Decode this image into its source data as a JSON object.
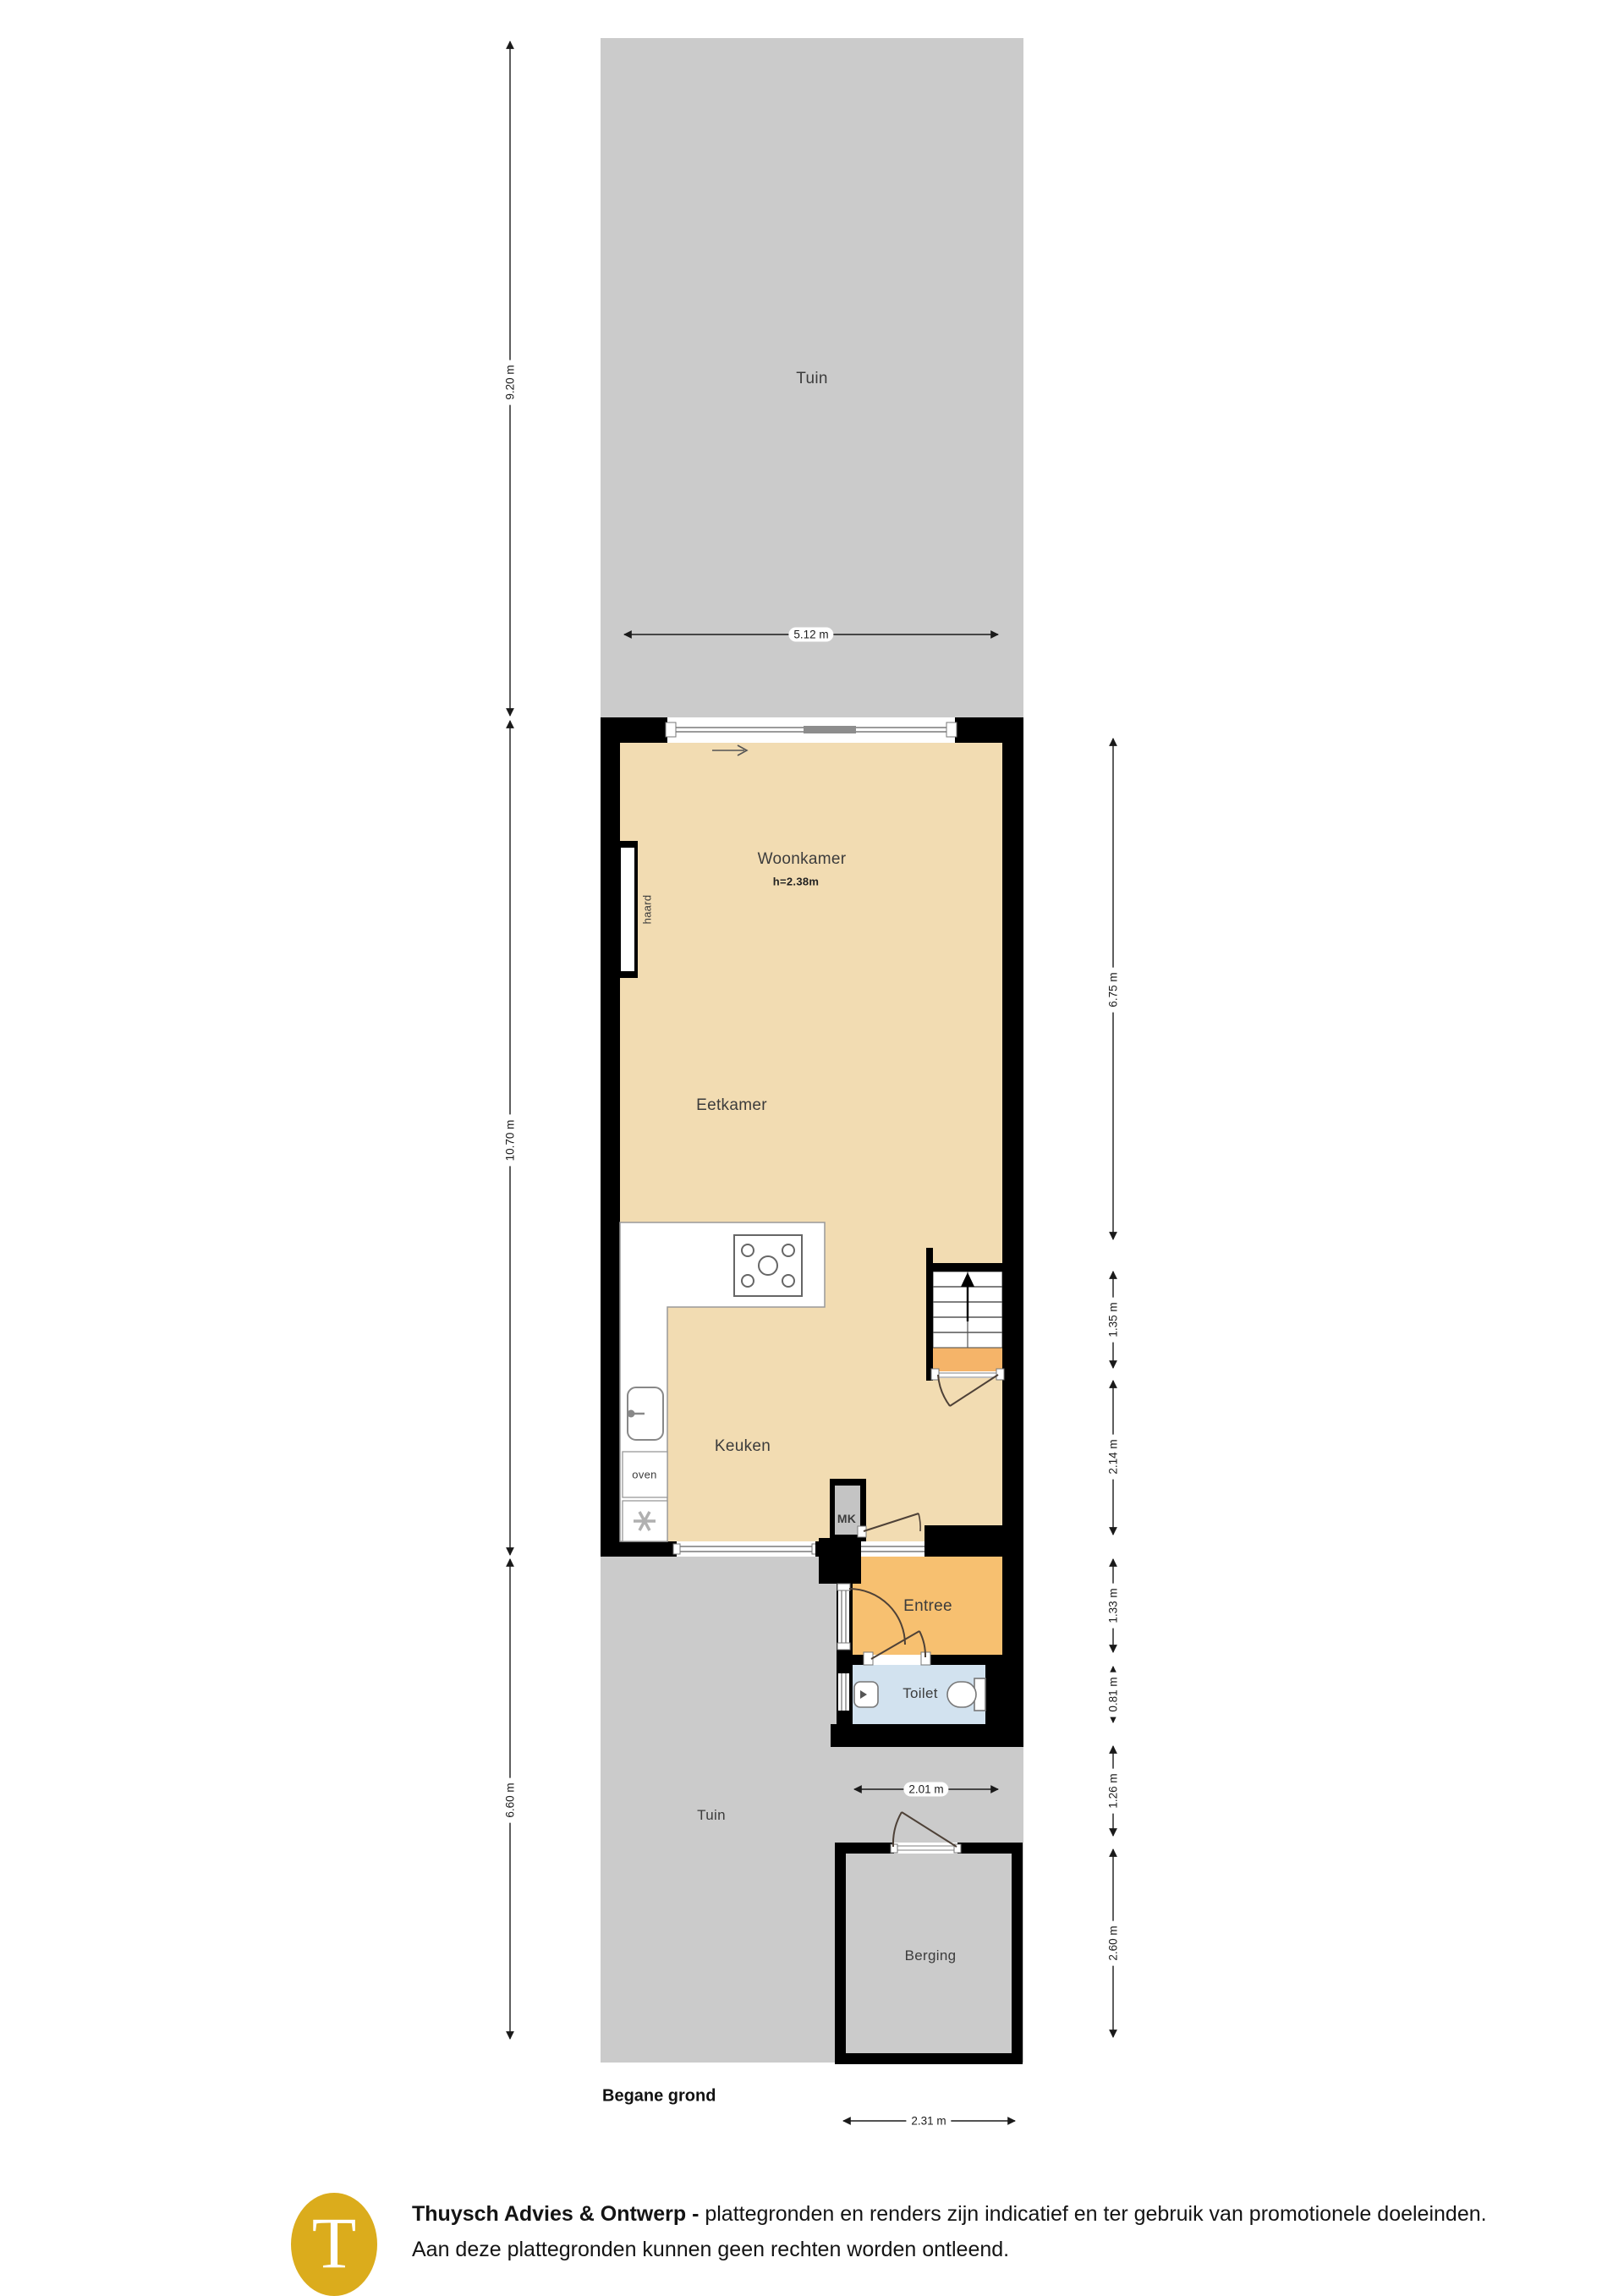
{
  "floor": {
    "title": "Begane grond"
  },
  "rooms": {
    "tuin_top": "Tuin",
    "woonkamer": "Woonkamer",
    "woonkamer_height": "h=2.38m",
    "eetkamer": "Eetkamer",
    "keuken": "Keuken",
    "entree": "Entree",
    "toilet": "Toilet",
    "tuin_bottom": "Tuin",
    "berging": "Berging",
    "mk": "MK",
    "haard": "haard",
    "oven": "oven"
  },
  "dimensions": {
    "left": [
      {
        "label": "9.20 m"
      },
      {
        "label": "10.70 m"
      },
      {
        "label": "6.60 m"
      }
    ],
    "right": [
      {
        "label": "6.75 m"
      },
      {
        "label": "1.35 m"
      },
      {
        "label": "2.14 m"
      },
      {
        "label": "1.33 m"
      },
      {
        "label": "0.81 m"
      },
      {
        "label": "1.26 m"
      },
      {
        "label": "2.60 m"
      }
    ],
    "horizontal": [
      {
        "label": "5.12 m"
      },
      {
        "label": "2.01 m"
      },
      {
        "label": "2.31 m"
      }
    ]
  },
  "footer": {
    "brand_bold": "Thuysch Advies & Ontwerp -",
    "line1_rest": " plattegronden en renders zijn indicatief en ter gebruik van promotionele doeleinden.",
    "line2": "Aan deze plattegronden kunnen geen rechten worden ontleend.",
    "logo_letter": "T"
  },
  "colors": {
    "wall": "#000000",
    "floor_main": "#F2DCB2",
    "floor_entree": "#F7C070",
    "stair_landing": "#F5B469",
    "floor_toilet": "#D2E2EF",
    "garden": "#CBCBCB",
    "meter_closet": "#C4C4C4",
    "counter": "#FFFFFF",
    "logo_gold": "#DBAC1C"
  }
}
